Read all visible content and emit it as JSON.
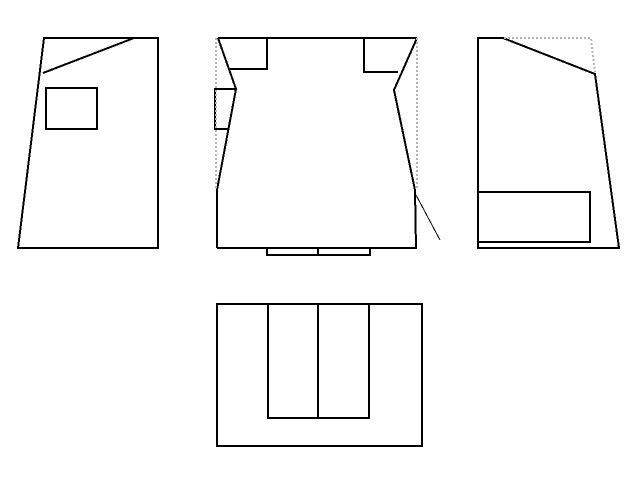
{
  "canvas": {
    "width": 640,
    "height": 480,
    "background": "#ffffff"
  },
  "colors": {
    "solid_line": "#000000",
    "hidden_line": "#b4b4b4",
    "background": "#ffffff"
  },
  "styles": {
    "solid": {
      "stroke": "#000000",
      "width": 2,
      "dash": ""
    },
    "thin": {
      "stroke": "#000000",
      "width": 1,
      "dash": ""
    },
    "dashed": {
      "stroke": "#b4b4b4",
      "width": 2,
      "dash": "2 2"
    }
  },
  "views": [
    {
      "name": "view-left-side",
      "shapes": [
        {
          "name": "left-outline",
          "style": "solid",
          "closed": true,
          "points": "44,38 158,38 158,248 18,248"
        },
        {
          "name": "left-diagonal-edge",
          "style": "solid",
          "closed": false,
          "points": "134,38 43,73"
        },
        {
          "name": "left-inner-rect",
          "style": "solid",
          "closed": true,
          "points": "46,88 97,88 97,129 46,129"
        }
      ]
    },
    {
      "name": "view-front",
      "shapes": [
        {
          "name": "front-top-edge",
          "style": "solid",
          "closed": false,
          "points": "218,38 417,38"
        },
        {
          "name": "front-bottom-edge",
          "style": "solid",
          "closed": false,
          "points": "217,248 417,248"
        },
        {
          "name": "front-left-edge",
          "style": "solid",
          "closed": false,
          "points": "218,38 236,89 217,190 217,248"
        },
        {
          "name": "front-right-edge",
          "style": "solid",
          "closed": false,
          "points": "417,38 394,90 415,190 416,248"
        },
        {
          "name": "front-left-notch",
          "style": "solid",
          "closed": false,
          "points": "267,38 267,69 229,69"
        },
        {
          "name": "front-right-notch",
          "style": "solid",
          "closed": false,
          "points": "364,38 364,72 398,72"
        },
        {
          "name": "front-left-inner-rect",
          "style": "solid",
          "closed": false,
          "points": "236,89 215,89 215,129 228,129"
        },
        {
          "name": "front-thin-diagonal",
          "style": "thin",
          "closed": false,
          "points": "416,195 440,240"
        },
        {
          "name": "front-bottom-tabs",
          "style": "solid",
          "closed": false,
          "points": "267,248 267,255 370,255 370,248"
        },
        {
          "name": "front-bottom-tab-divider",
          "style": "solid",
          "closed": false,
          "points": "318,248 318,255"
        },
        {
          "name": "front-left-hidden-line",
          "style": "dashed",
          "closed": false,
          "points": "216,38 216,188"
        },
        {
          "name": "front-right-hidden-line",
          "style": "dashed",
          "closed": false,
          "points": "417,38 417,190"
        }
      ]
    },
    {
      "name": "view-right-side",
      "shapes": [
        {
          "name": "right-outline",
          "style": "solid",
          "closed": true,
          "points": "478,38 503,38 595,74 619,248 478,248"
        },
        {
          "name": "right-inner-rect",
          "style": "solid",
          "closed": false,
          "points": "478,192 590,192 590,242 478,242"
        },
        {
          "name": "right-hidden-line",
          "style": "dashed",
          "closed": false,
          "points": "504,38 591,38 595,72"
        }
      ]
    },
    {
      "name": "view-bottom",
      "shapes": [
        {
          "name": "bottom-outline",
          "style": "solid",
          "closed": true,
          "points": "217,304 422,304 422,446 217,446"
        },
        {
          "name": "bottom-inner-channel",
          "style": "solid",
          "closed": false,
          "points": "268,304 268,418 369,418 369,304"
        },
        {
          "name": "bottom-inner-divider",
          "style": "solid",
          "closed": false,
          "points": "318,304 318,418"
        }
      ]
    }
  ]
}
